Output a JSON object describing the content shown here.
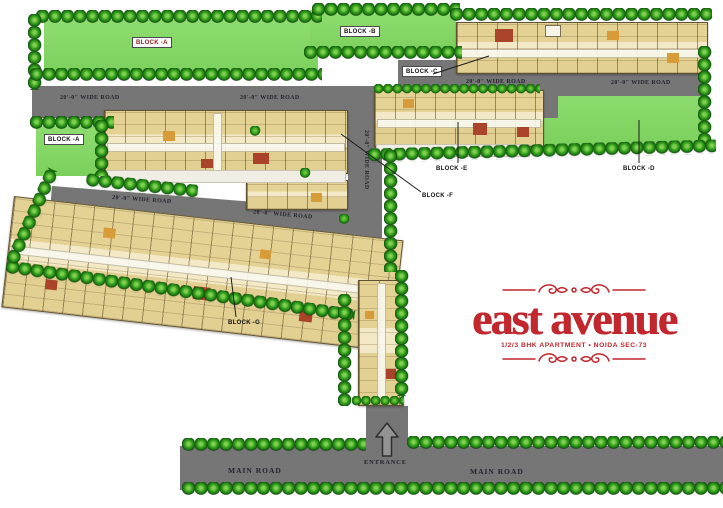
{
  "logo": {
    "wordmark": "east avenue",
    "tagline": "1/2/3 BHK APARTMENT • NOIDA SEC-73"
  },
  "blocks": {
    "lawn_a": {
      "label": "BLOCK -A"
    },
    "lawn_a_small": {
      "label": "BLOCK -A"
    },
    "lawn_b": {
      "label": "BLOCK -B"
    },
    "block_c": {
      "label": "BLOCK -C"
    },
    "lawn_d": {
      "label": "BLOCK -D"
    },
    "block_e": {
      "label": "BLOCK -E"
    },
    "block_f": {
      "label": "BLOCK -F"
    },
    "block_g": {
      "label": "BLOCK -G"
    }
  },
  "roads": {
    "wide_road_label": "20'-0\" WIDE ROAD",
    "main_road_label": "MAIN ROAD",
    "entrance_label": "ENTRANCE"
  },
  "icons": {
    "entrance_arrow": "arrow-up-icon",
    "ornament": "flourish-icon",
    "tree": "tree-ball-icon"
  },
  "colors": {
    "lawn_green": "#8edc70",
    "lawn_green_dark": "#7bd05c",
    "tree_green": "#1f7a14",
    "road_gray": "#767676",
    "building_tan": "#eadfae",
    "building_line": "#5f5233",
    "accent_rust": "#a9442b",
    "accent_orange": "#d79b3a",
    "logo_red": "#c1272d",
    "label_black": "#131313",
    "road_text": "#24242e"
  }
}
